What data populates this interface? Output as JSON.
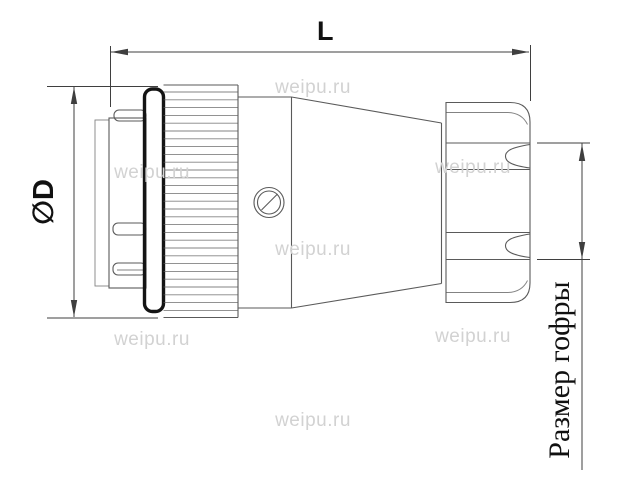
{
  "labels": {
    "length": "L",
    "diameter": "∅D",
    "corrugation": "Размер гофры"
  },
  "watermark": {
    "text": "weipu.ru"
  },
  "colors": {
    "line": "#5a5a5a",
    "outline_heavy": "#141414",
    "dimension": "#3f3f3f",
    "watermark": "#d2d2d2",
    "background": "#ffffff"
  }
}
